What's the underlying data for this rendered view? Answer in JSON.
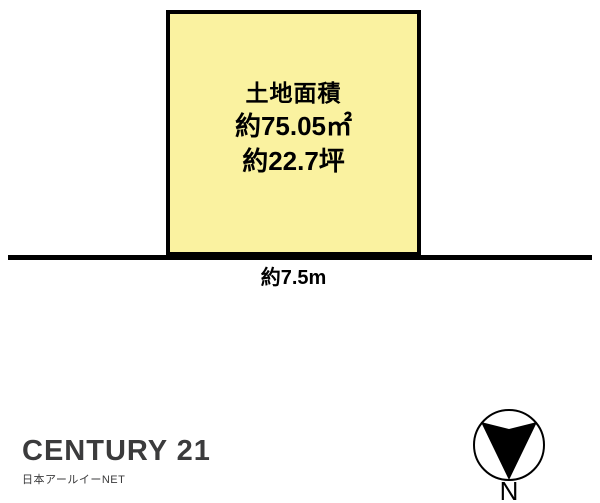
{
  "plot": {
    "title": "土地面積",
    "area_sqm": "約75.05㎡",
    "area_tsubo": "約22.7坪",
    "fill_color": "#FAF2A0",
    "border_color": "#000000"
  },
  "road": {
    "width_label": "約7.5m",
    "line_color": "#000000"
  },
  "compass": {
    "north_label": "N"
  },
  "branding": {
    "logo_text": "CENTURY 21",
    "subtext": "日本アールイーNET",
    "text_color": "#3B3B3C"
  }
}
